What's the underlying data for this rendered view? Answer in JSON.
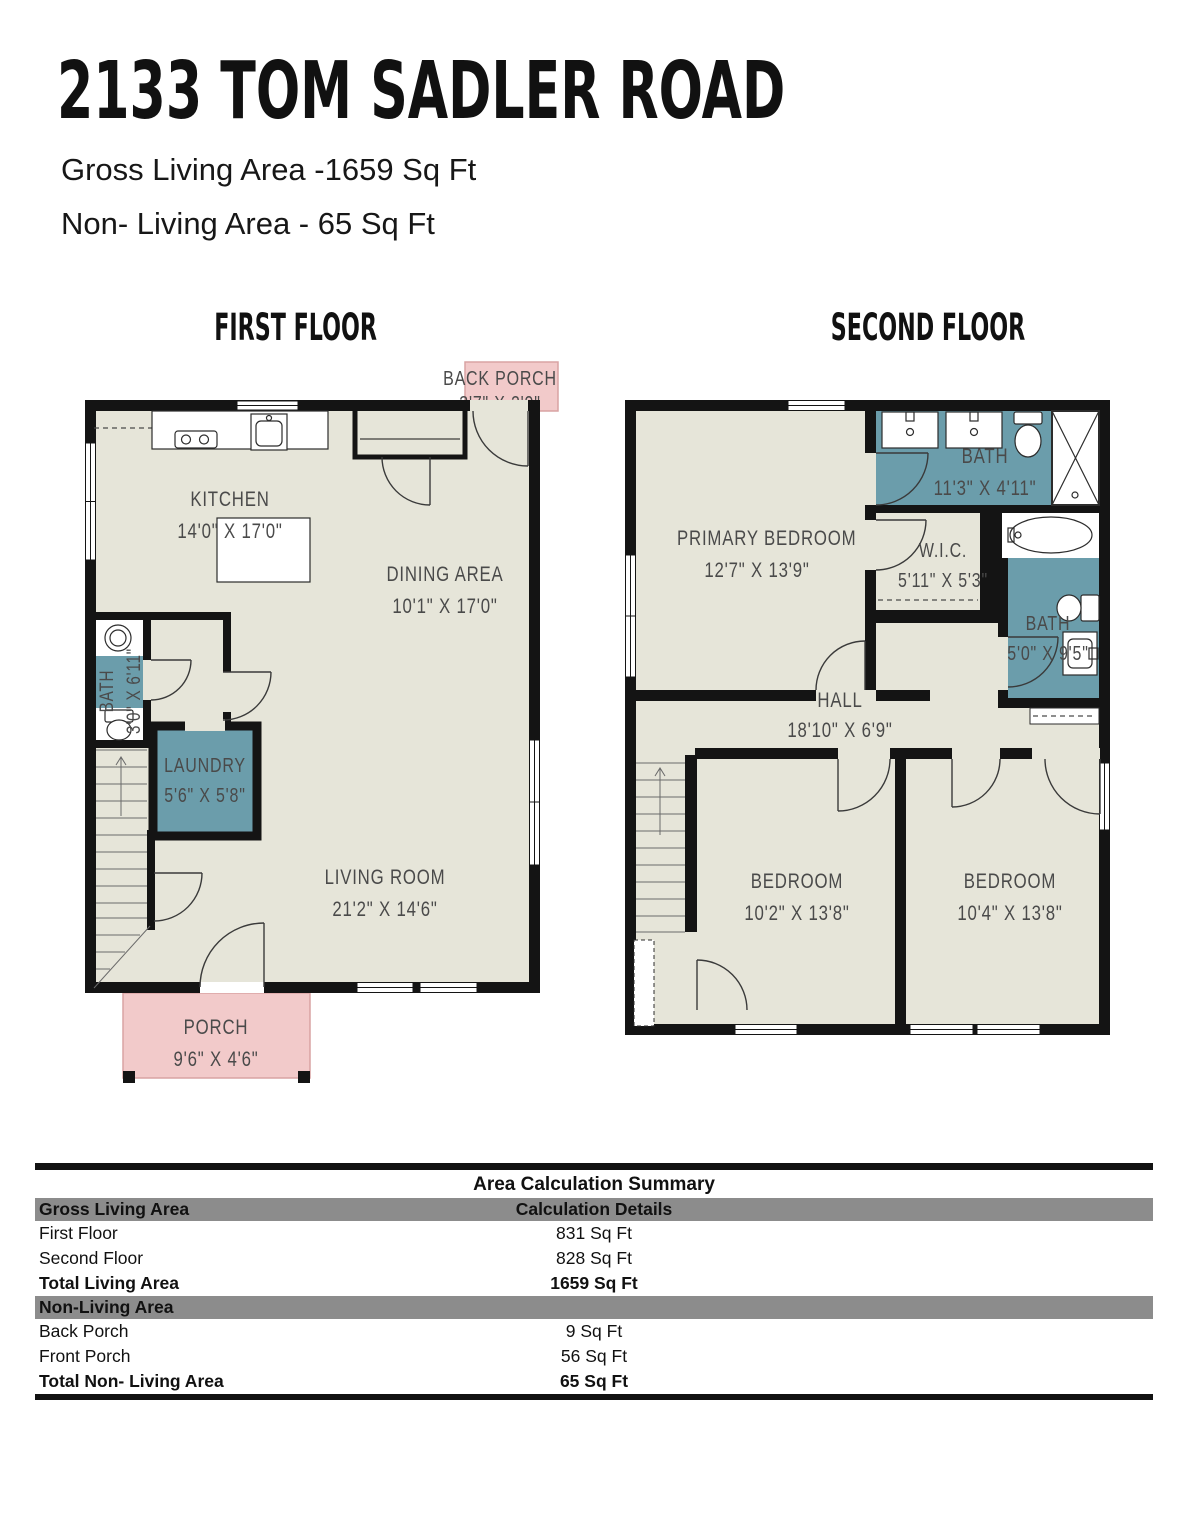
{
  "header": {
    "title": "2133 TOM SADLER ROAD",
    "gross_living": "Gross Living Area -1659 Sq Ft",
    "non_living": "Non- Living Area - 65 Sq Ft"
  },
  "floors": {
    "first": {
      "label": "FIRST FLOOR",
      "rooms": {
        "back_porch": {
          "name": "BACK PORCH",
          "dims": "3'7\" X 2'9\""
        },
        "kitchen": {
          "name": "KITCHEN",
          "dims": "14'0\" X 17'0\""
        },
        "dining": {
          "name": "DINING AREA",
          "dims": "10'1\" X 17'0\""
        },
        "bath": {
          "name": "BATH",
          "dims": "3'0\" X 6'11\""
        },
        "laundry": {
          "name": "LAUNDRY",
          "dims": "5'6\" X 5'8\""
        },
        "living": {
          "name": "LIVING ROOM",
          "dims": "21'2\" X 14'6\""
        },
        "porch": {
          "name": "PORCH",
          "dims": "9'6\" X 4'6\""
        }
      }
    },
    "second": {
      "label": "SECOND FLOOR",
      "rooms": {
        "primary": {
          "name": "PRIMARY BEDROOM",
          "dims": "12'7\" X 13'9\""
        },
        "bath1": {
          "name": "BATH",
          "dims": "11'3\" X 4'11\""
        },
        "wic": {
          "name": "W.I.C.",
          "dims": "5'11\" X 5'3\""
        },
        "bath2": {
          "name": "BATH",
          "dims": "5'0\" X 9'5\""
        },
        "hall": {
          "name": "HALL",
          "dims": "18'10\" X 6'9\""
        },
        "bedroom1": {
          "name": "BEDROOM",
          "dims": "10'2\" X 13'8\""
        },
        "bedroom2": {
          "name": "BEDROOM",
          "dims": "10'4\" X 13'8\""
        }
      }
    }
  },
  "summary": {
    "title": "Area Calculation Summary",
    "sections": [
      {
        "header": "Gross Living Area",
        "header_value": "Calculation Details",
        "rows": [
          {
            "label": "First Floor",
            "value": "831 Sq Ft"
          },
          {
            "label": "Second Floor",
            "value": "828 Sq Ft"
          }
        ],
        "total": {
          "label": "Total Living Area",
          "value": "1659 Sq Ft"
        }
      },
      {
        "header": "Non-Living Area",
        "header_value": "",
        "rows": [
          {
            "label": "Back Porch",
            "value": "9 Sq Ft"
          },
          {
            "label": "Front Porch",
            "value": "56 Sq Ft"
          }
        ],
        "total": {
          "label": "Total Non- Living Area",
          "value": "65 Sq Ft"
        }
      }
    ]
  },
  "colors": {
    "floor": "#e6e5d9",
    "wet_room_teal": "#6b9dab",
    "porch_pink": "#f2caca",
    "wall": "#141414",
    "table_header_bg": "#8c8c8c"
  }
}
